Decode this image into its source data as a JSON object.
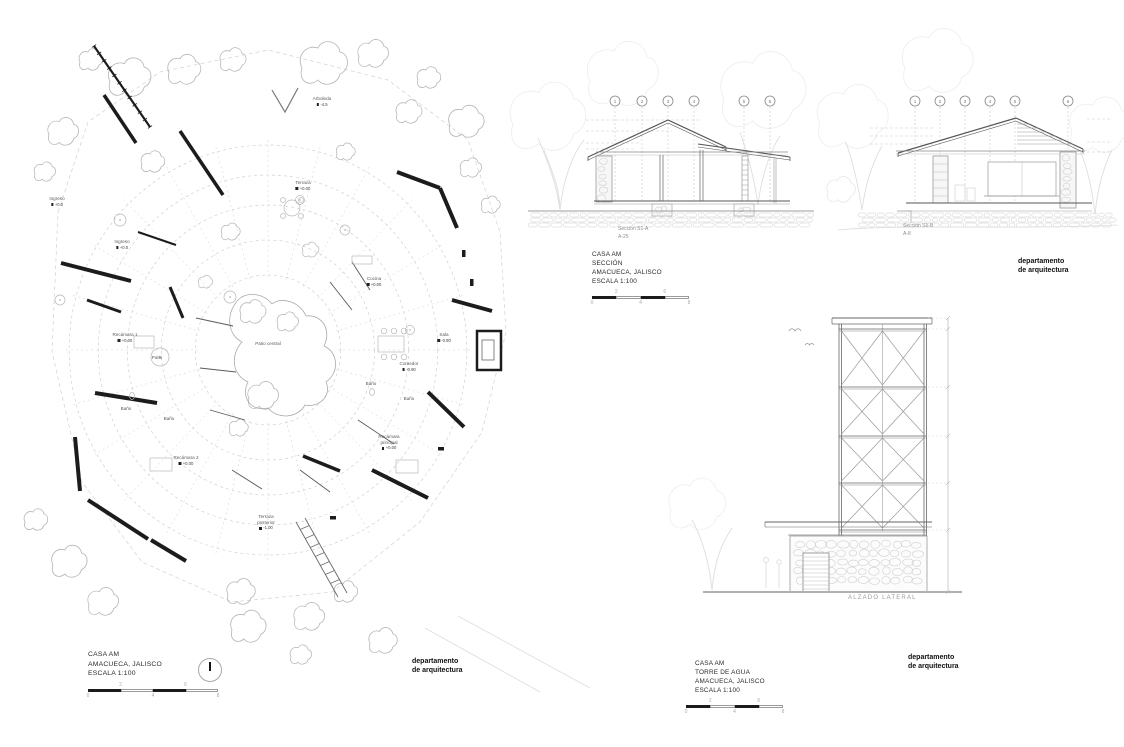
{
  "plan": {
    "room_labels": [
      {
        "name": "Arboleda",
        "level": "-4.5"
      },
      {
        "name": "Ingreso",
        "level": "+0.0"
      },
      {
        "name": "Terraza",
        "level": "+0.00"
      },
      {
        "name": "Ingreso",
        "level": "+0.0"
      },
      {
        "name": "Cocina",
        "level": "+0.00"
      },
      {
        "name": "Recámara 1",
        "level": "+0.00"
      },
      {
        "name": "Patio"
      },
      {
        "name": "Patio central"
      },
      {
        "name": "Sala",
        "level": "-0.90"
      },
      {
        "name": "Comedor",
        "level": "-0.90"
      },
      {
        "name": "Baño"
      },
      {
        "name": "Baño"
      },
      {
        "name": "Baño"
      },
      {
        "name": "Baño"
      },
      {
        "name": "Recámara 2",
        "level": "+0.00"
      },
      {
        "name": "Recámara principal",
        "level": "+0.00"
      },
      {
        "name": "Terraza posterior",
        "level": "-1.00"
      }
    ],
    "title": [
      "CASA AM",
      "AMACUECA, JALISCO",
      "ESCALA 1:100"
    ],
    "scale_numbers": [
      "0",
      "2",
      "4",
      "6",
      "8"
    ],
    "credit": [
      "departamento",
      "de arquitectura"
    ]
  },
  "sections": {
    "grid_marks_a": [
      "1",
      "2",
      "3",
      "4",
      "5",
      "6"
    ],
    "grid_marks_b": [
      "1",
      "2",
      "3",
      "4",
      "5",
      "6"
    ],
    "caption_a": [
      "Sección S1-A",
      "A-25"
    ],
    "caption_b": [
      "Sección S1-B",
      "A-8"
    ],
    "title": [
      "CASA AM",
      "SECCIÓN",
      "AMACUECA, JALISCO",
      "ESCALA 1:100"
    ],
    "scale_numbers": [
      "0",
      "2",
      "4",
      "6",
      "8"
    ],
    "credit": [
      "departamento",
      "de arquitectura"
    ]
  },
  "tower": {
    "caption": "ALZADO LATERAL",
    "title": [
      "CASA AM",
      "TORRE DE AGUA",
      "AMACUECA, JALISCO",
      "ESCALA 1:100"
    ],
    "scale_numbers": [
      "0",
      "2",
      "4",
      "6",
      "8"
    ],
    "credit": [
      "departamento",
      "de arquitectura"
    ]
  }
}
